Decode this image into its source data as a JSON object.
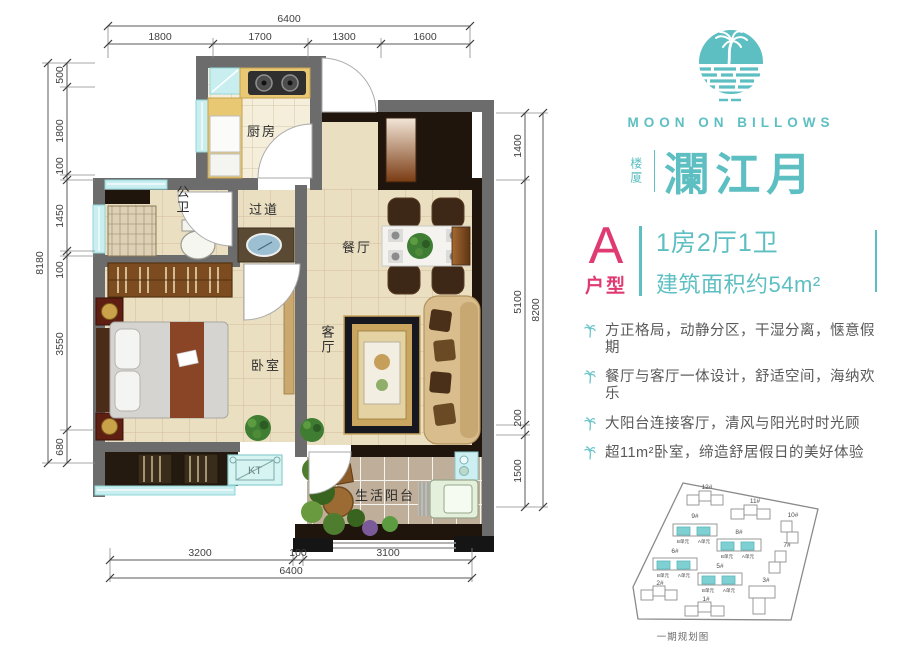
{
  "colors": {
    "teal": "#5ebfc2",
    "pink": "#e03a72",
    "wall_gray": "#6c6c6c",
    "marble_black": "#20150c"
  },
  "plan": {
    "rooms": {
      "kitchen": "厨房",
      "bath": "公卫",
      "hallway": "过道",
      "dining": "餐厅",
      "bedroom": "卧室",
      "living": "客厅",
      "balcony": "生活阳台",
      "ac_unit": "KT"
    },
    "dims": {
      "top": {
        "total": "6400",
        "segments": [
          "1800",
          "1700",
          "1300",
          "1600"
        ]
      },
      "bottom": {
        "total": "6400",
        "segments": [
          "3200",
          "100",
          "3100"
        ]
      },
      "left": {
        "total": "8180",
        "segments": [
          "500",
          "1800",
          "100",
          "1450",
          "100",
          "3550",
          "680"
        ]
      },
      "right": {
        "total": "8200",
        "segments": [
          "1400",
          "5100",
          "200",
          "1500"
        ]
      }
    }
  },
  "brand": {
    "en": "MOON ON BILLOWS",
    "prefix": "楼厦",
    "name": "瀾江月"
  },
  "unit": {
    "letter": "A",
    "type_label": "户型",
    "layout": "1房2厅1卫",
    "area": "建筑面积约54m²"
  },
  "features": [
    "方正格局，动静分区，干湿分离，惬意假期",
    "餐厅与客厅一体设计，舒适空间，海纳欢乐",
    "大阳台连接客厅，清风与阳光时时光顾",
    "超11m²卧室，缔造舒居假日的美好体验"
  ],
  "siteplan": {
    "caption": "一期规划图",
    "buildings": [
      "12#",
      "11#",
      "10#",
      "9#",
      "8#",
      "7#",
      "6#",
      "5#",
      "2#",
      "3#",
      "1#"
    ],
    "unit_a": "A单元",
    "unit_b": "B单元"
  }
}
